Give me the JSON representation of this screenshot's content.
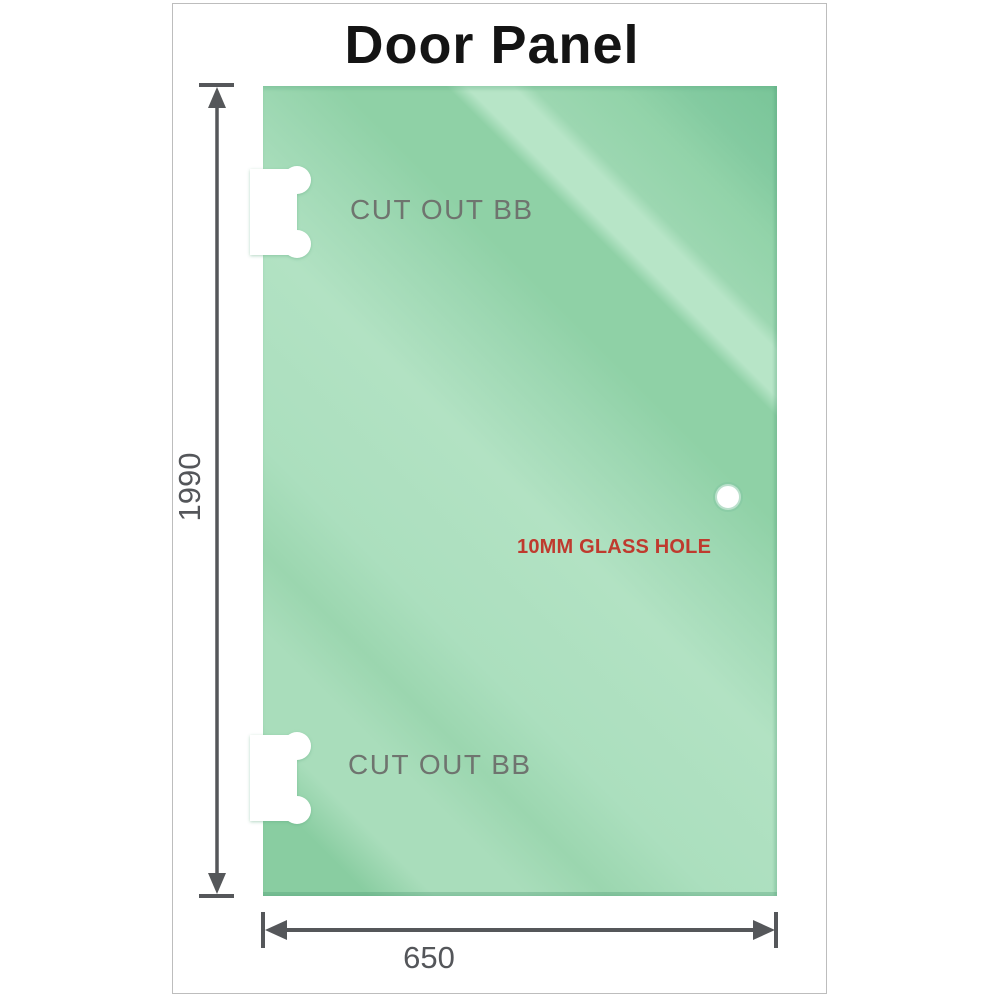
{
  "title": "Door Panel",
  "panel": {
    "top_cutout_label": "CUT OUT BB",
    "bottom_cutout_label": "CUT OUT BB",
    "hole_label": "10MM GLASS HOLE"
  },
  "dimensions": {
    "height_label": "1990",
    "width_label": "650"
  },
  "colors": {
    "glass_base": "#8fd1a6",
    "glass_light_band": "#b7e5c7",
    "glass_dark_corner": "#79c598",
    "dimension_gray": "#55575a",
    "cutout_label_gray": "#6f746f",
    "hole_label_red": "#bf3a2e",
    "frame_border_gray": "#bdbdbd",
    "title_black": "#141414"
  }
}
